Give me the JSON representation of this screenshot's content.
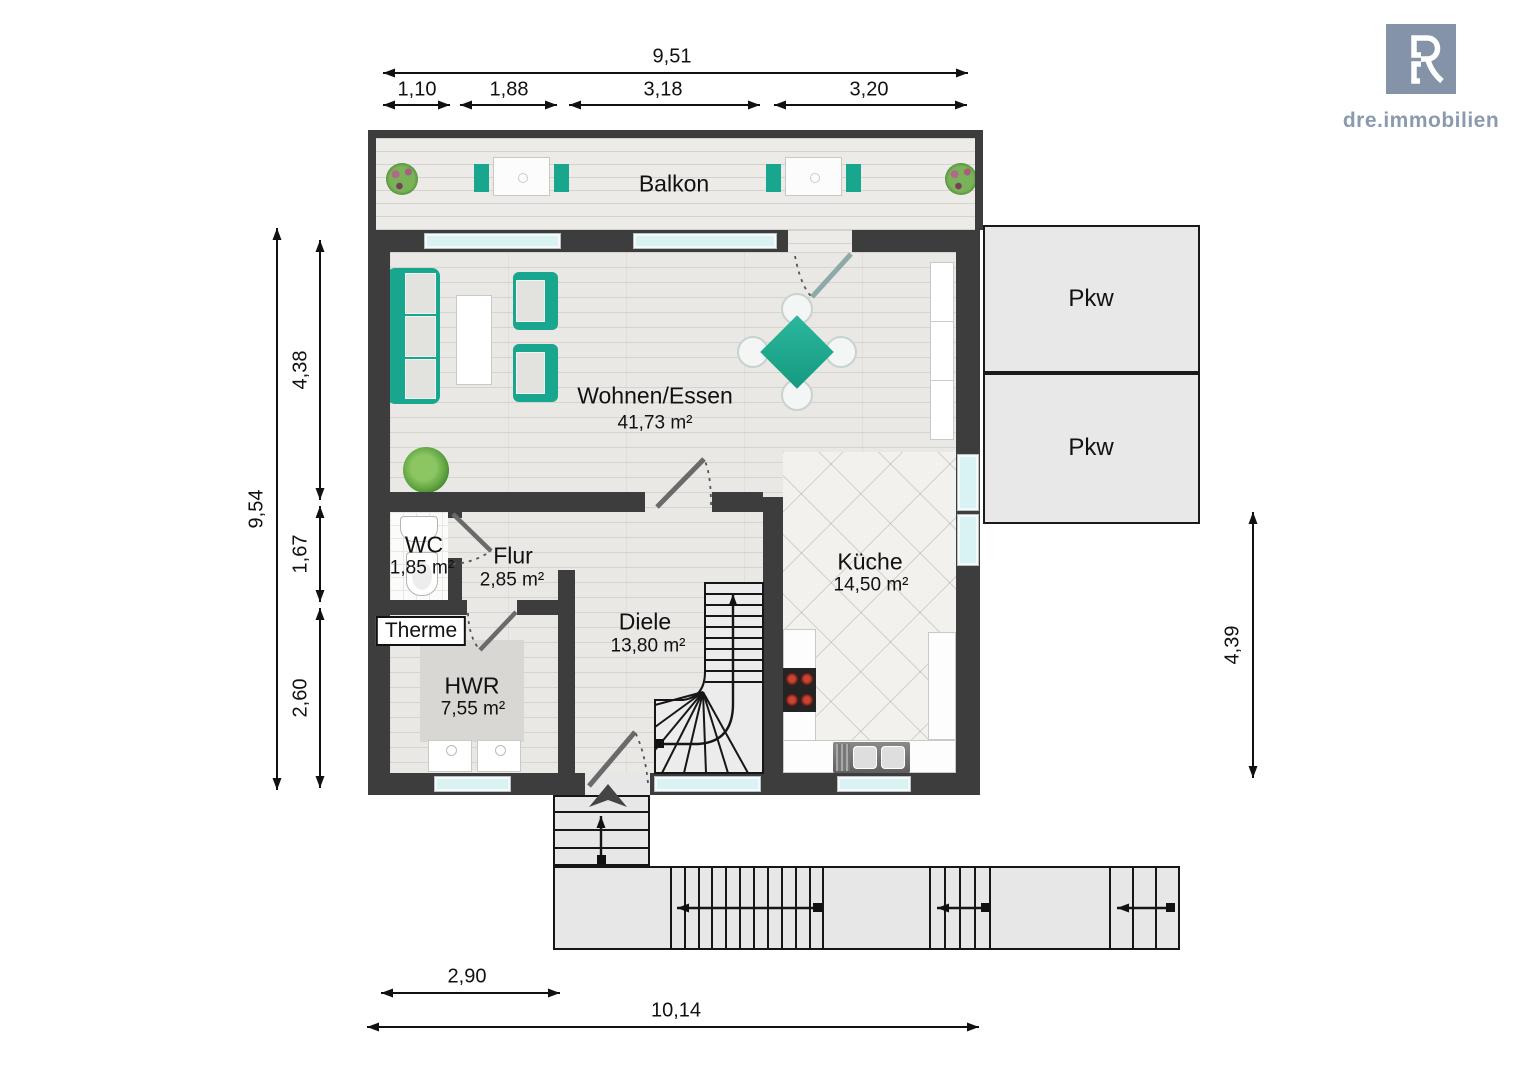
{
  "brand": {
    "name": "dre.immobilien"
  },
  "rooms": {
    "balkon": {
      "name": "Balkon"
    },
    "wohnen": {
      "name": "Wohnen/Essen",
      "area": "41,73 m²"
    },
    "wc": {
      "name": "WC",
      "area": "1,85 m²"
    },
    "flur": {
      "name": "Flur",
      "area": "2,85 m²"
    },
    "diele": {
      "name": "Diele",
      "area": "13,80 m²"
    },
    "kueche": {
      "name": "Küche",
      "area": "14,50 m²"
    },
    "hwr": {
      "name": "HWR",
      "area": "7,55 m²"
    },
    "therme": {
      "name": "Therme"
    }
  },
  "parking": {
    "space1": "Pkw",
    "space2": "Pkw"
  },
  "dimensions": {
    "top_total": "9,51",
    "top_segments": [
      "1,10",
      "1,88",
      "3,18",
      "3,20"
    ],
    "left_total": "9,54",
    "left_segments": [
      "4,38",
      "1,67",
      "2,60"
    ],
    "right_height": "4,39",
    "bottom_inner": "2,90",
    "bottom_total": "10,14"
  },
  "colors": {
    "accent_teal": "#18a78e",
    "wall": "#3d3d3d",
    "logo_blue": "#8493a8"
  }
}
